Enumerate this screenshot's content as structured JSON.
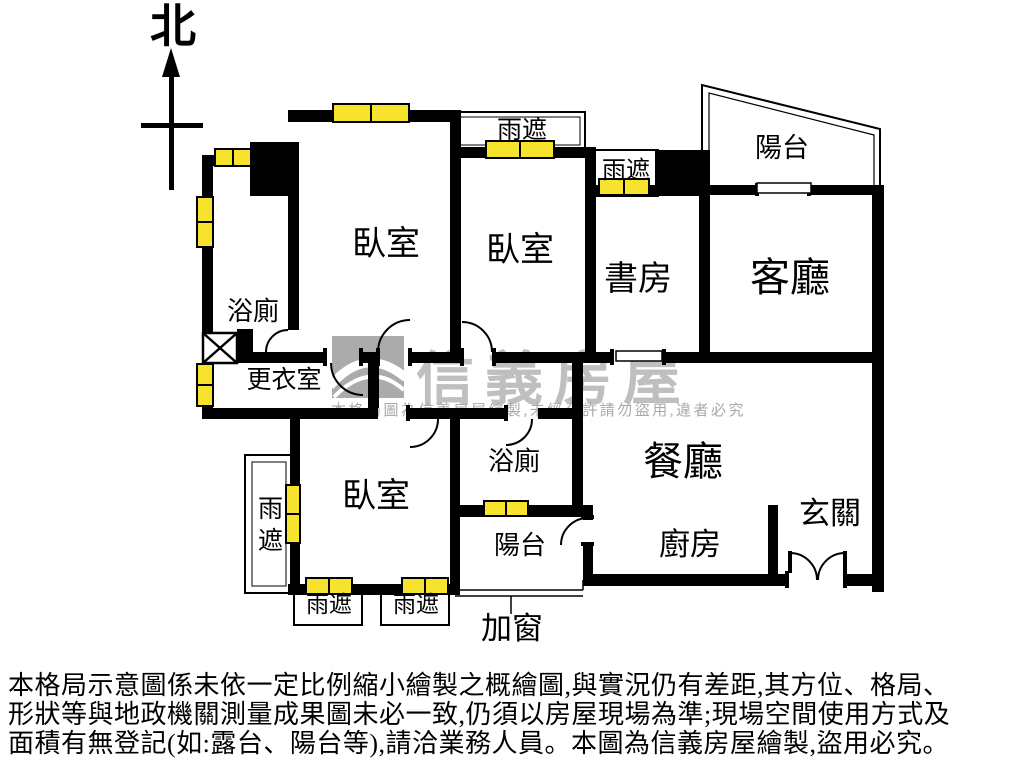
{
  "compass": {
    "north_label": "北"
  },
  "rooms": {
    "bathroom_top": "浴廁",
    "bedroom_top_left": "臥室",
    "bedroom_top_mid": "臥室",
    "study": "書房",
    "living_room": "客廳",
    "balcony_top": "陽台",
    "dressing_room": "更衣室",
    "bedroom_bottom": "臥室",
    "bathroom_bottom": "浴廁",
    "balcony_bottom": "陽台",
    "dining_room": "餐廳",
    "kitchen": "廚房",
    "foyer": "玄關"
  },
  "annotations": {
    "rain_canopy": "雨遮",
    "added_window": "加窗"
  },
  "watermark": {
    "brand": "信義房屋",
    "notice": "本格局圖為信義房屋繪製,未經允許請勿盜用,違者必究"
  },
  "disclaimer": {
    "line1": "本格局示意圖係未依一定比例縮小繪製之概繪圖,與實況仍有差距,其方位、格局、",
    "line2": "形狀等與地政機關測量成果圖未必一致,仍須以房屋現場為準;現場空間使用方式及",
    "line3": "面積有無登記(如:露台、陽台等),請洽業務人員。本圖為信義房屋繪製,盜用必究。"
  },
  "colors": {
    "wall": "#000000",
    "window_fill": "#f5e32e",
    "watermark_gray": "#b5b5b5"
  }
}
